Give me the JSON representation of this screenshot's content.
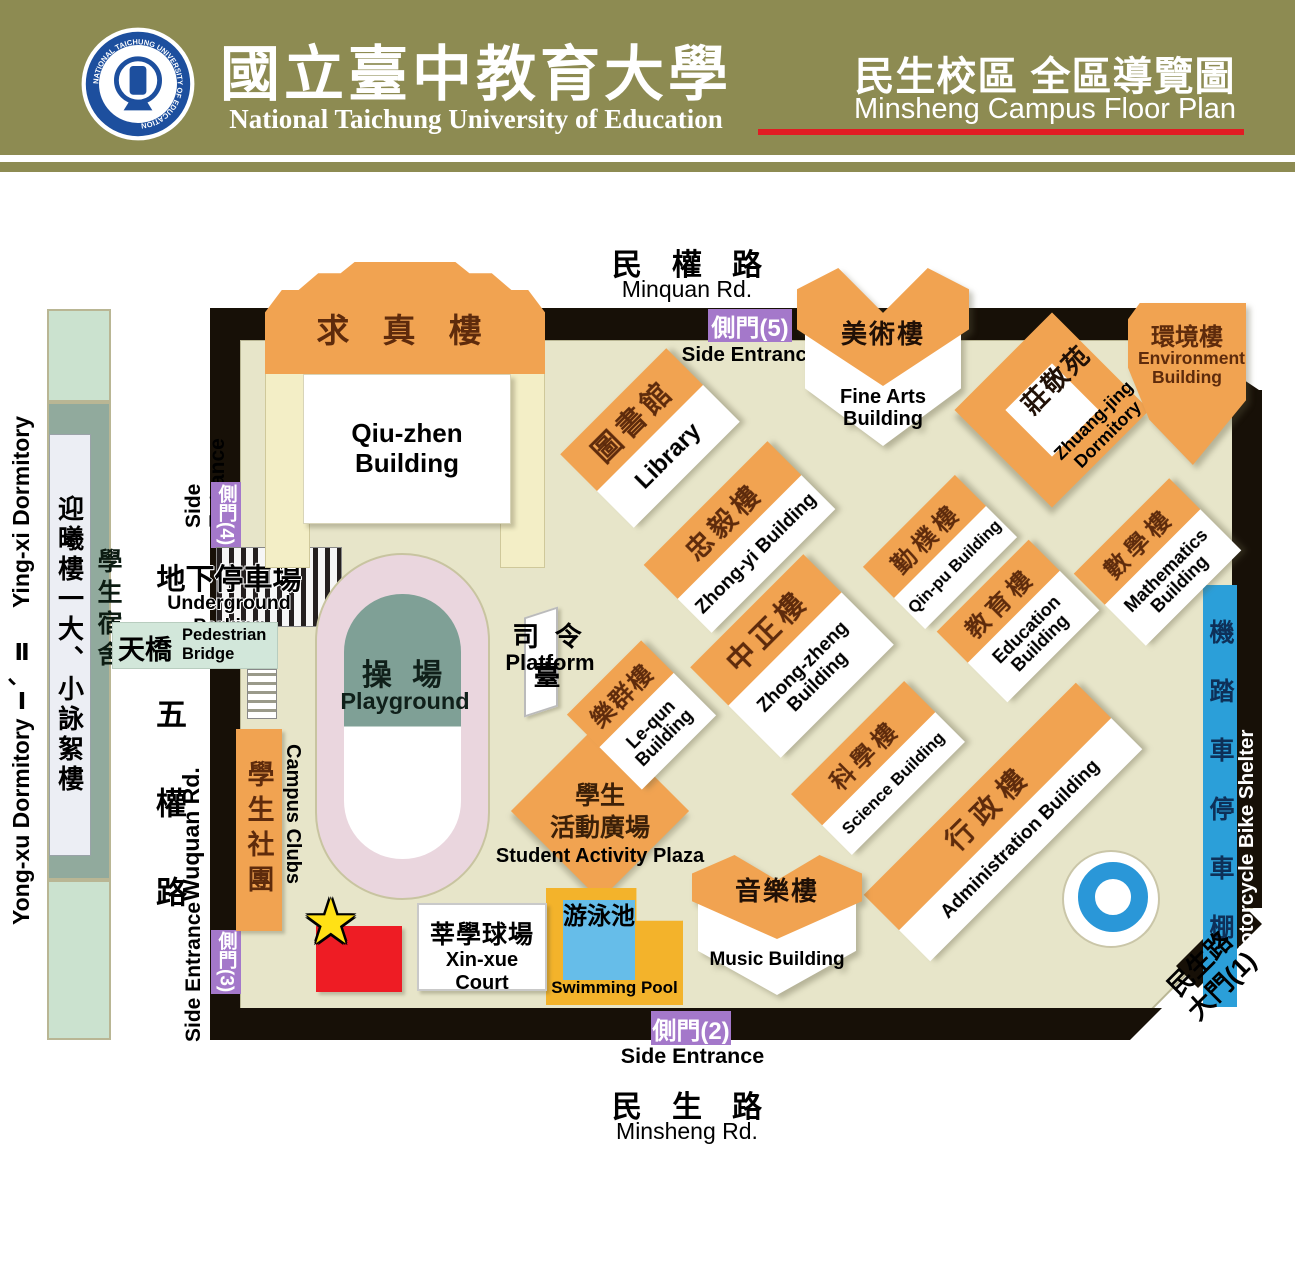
{
  "header": {
    "university_zh": "國立臺中教育大學",
    "university_en": "National Taichung University of Education",
    "logo_ring_text": "NATIONAL TAICHUNG UNIVERSITY OF EDUCATION",
    "campus_title_zh": "民生校區 全區導覽圖",
    "campus_title_en": "Minsheng Campus Floor Plan",
    "colors": {
      "band": "#8d8b52",
      "underline": "#e11c23"
    }
  },
  "roads": {
    "minquan_zh": "民　權　路",
    "minquan_en": "Minquan Rd.",
    "minsheng_zh": "民　生　路",
    "minsheng_en": "Minsheng Rd.",
    "wuquan_zh": "五權路",
    "wuquan_en": "Wuquan Rd."
  },
  "gates": {
    "se2_zh": "側門(2)",
    "se2_en": "Side Entrance",
    "se3_zh": "側門(3)",
    "se3_en": "Side Entrance",
    "se4_zh": "側門(4)",
    "se4_en": "Side Entrance",
    "se5_zh": "側門(5)",
    "se5_en": "Side Entrance",
    "main_gate_zh": "民生路\n大門(1)"
  },
  "buildings": {
    "qiuzhen": {
      "zh": "求 真 樓",
      "en": "Qiu-zhen Building"
    },
    "library": {
      "zh": "圖書館",
      "en": "Library"
    },
    "zhongyi": {
      "zh": "忠毅樓",
      "en": "Zhong-yi Building"
    },
    "finearts": {
      "zh": "美術樓",
      "en": "Fine Arts Building"
    },
    "zhuangjing": {
      "zh": "莊敬苑",
      "en": "Zhuang-jing Dormitory"
    },
    "environment": {
      "zh": "環境樓",
      "en": "Environment Building"
    },
    "qinpu": {
      "zh": "勤樸樓",
      "en": "Qin-pu Building"
    },
    "education": {
      "zh": "教育樓",
      "en": "Education Building"
    },
    "mathematics": {
      "zh": "數學樓",
      "en": "Mathematics Building"
    },
    "zhongzheng": {
      "zh": "中正樓",
      "en": "Zhong-zheng Building"
    },
    "lequn": {
      "zh": "樂群樓",
      "en": "Le-qun Building"
    },
    "science": {
      "zh": "科學樓",
      "en": "Science Building"
    },
    "administration": {
      "zh": "行政樓",
      "en": "Administration Building"
    },
    "music": {
      "zh": "音樂樓",
      "en": "Music Building"
    }
  },
  "facilities": {
    "playground": {
      "zh": "操 場",
      "en": "Playground"
    },
    "platform": {
      "zh": "司 令 臺",
      "en": "Platform"
    },
    "campus_clubs": {
      "zh": "學生社團",
      "en": "Campus Clubs"
    },
    "plaza": {
      "zh1": "學生",
      "zh2": "活動廣場",
      "en": "Student Activity Plaza"
    },
    "pool": {
      "zh": "游泳池",
      "en": "Swimming Pool"
    },
    "xinxue": {
      "zh": "莘學球場",
      "en": "Xin-xue Court"
    },
    "parking": {
      "zh": "地下停車場",
      "en": "Underground Parking"
    },
    "bridge": {
      "zh": "天橋",
      "en": "Pedestrian Bridge"
    },
    "bike_shelter": {
      "zh": "機踏車停車棚",
      "en": "Motorcycle Bike Shelter"
    }
  },
  "dormitory": {
    "side_label": "Yong-xu Dormitory Ⅰ、Ⅱ　 Ying-xi Dormitory",
    "hall_zh": "迎曦樓一大、小詠絮樓",
    "dorm_zh": "學生宿舍"
  }
}
